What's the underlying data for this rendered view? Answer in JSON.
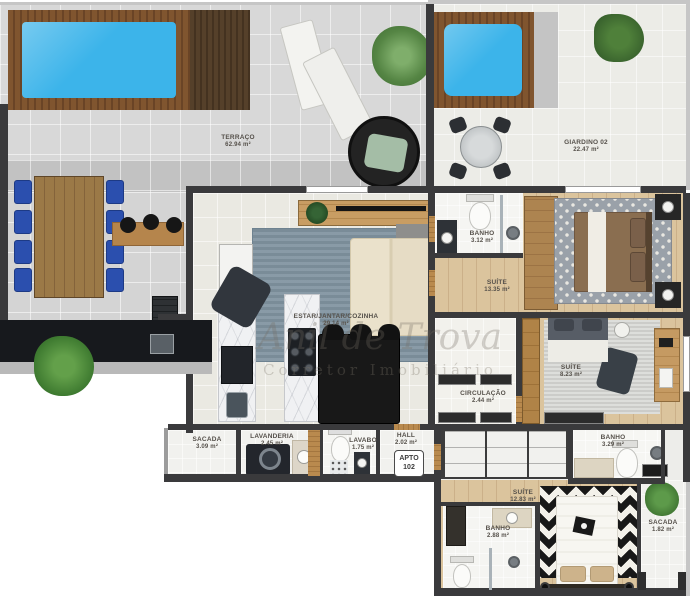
{
  "rooms": {
    "terraco": {
      "label": "TERRAÇO",
      "area": "62.94 m²"
    },
    "giardino": {
      "label": "GIARDINO 02",
      "area": "22.47 m²"
    },
    "banho1": {
      "label": "BANHO",
      "area": "3.12 m²"
    },
    "suite1": {
      "label": "SUÍTE",
      "area": "13.35 m²"
    },
    "estar": {
      "label": "ESTAR/JANTAR/COZINHA",
      "area": "29.14 m²"
    },
    "suite2": {
      "label": "SUÍTE",
      "area": "8.23 m²"
    },
    "circulacao": {
      "label": "CIRCULAÇÃO",
      "area": "2.44 m²"
    },
    "sacada1": {
      "label": "SACADA",
      "area": "3.09 m²"
    },
    "lavanderia": {
      "label": "LAVANDERIA",
      "area": "2.45 m²"
    },
    "lavabo": {
      "label": "LAVABO",
      "area": "1.75 m²"
    },
    "hall": {
      "label": "HALL",
      "area": "2.02 m²"
    },
    "banho2": {
      "label": "BANHO",
      "area": "3.29 m²"
    },
    "suite3": {
      "label": "SUÍTE",
      "area": "12.83 m²"
    },
    "banho3": {
      "label": "BANHO",
      "area": "2.88 m²"
    },
    "sacada2": {
      "label": "SACADA",
      "area": "1.82 m²"
    }
  },
  "badge": {
    "line1": "APTO",
    "line2": "102"
  },
  "watermark": {
    "line1": "Anil de Trova",
    "line2": "Corretor Imobiliário"
  },
  "colors": {
    "pool_water": "#3cb4ea",
    "deck_wood": "#7d5433",
    "wall": "#3a3a3c",
    "living_rug": "#8093a0",
    "chair_blue": "#2b4fae"
  }
}
